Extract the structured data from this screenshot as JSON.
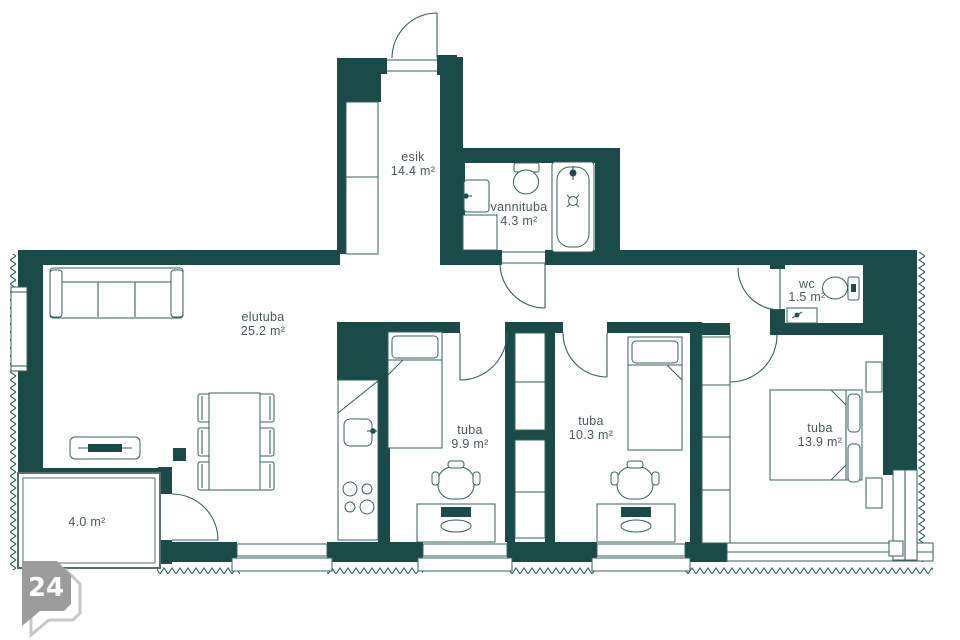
{
  "floorplan": {
    "badge": {
      "number": "24"
    },
    "rooms": {
      "esik": {
        "name": "esik",
        "area": "14.4 m²"
      },
      "vannituba": {
        "name": "vannituba",
        "area": "4.3 m²"
      },
      "elutuba": {
        "name": "elutuba",
        "area": "25.2 m²"
      },
      "wc": {
        "name": "wc",
        "area": "1.5 m²"
      },
      "tuba_small": {
        "name": "tuba",
        "area": "9.9 m²"
      },
      "tuba_mid": {
        "name": "tuba",
        "area": "10.3 m²"
      },
      "tuba_master": {
        "name": "tuba",
        "area": "13.9 m²"
      },
      "balcony": {
        "area": "4.0 m²"
      }
    },
    "colors": {
      "wall": "#1A4B48",
      "line": "#35615E",
      "text": "#4A575B",
      "badge": "#9C9C9C",
      "badge_outline": "#C7C7C7"
    }
  }
}
